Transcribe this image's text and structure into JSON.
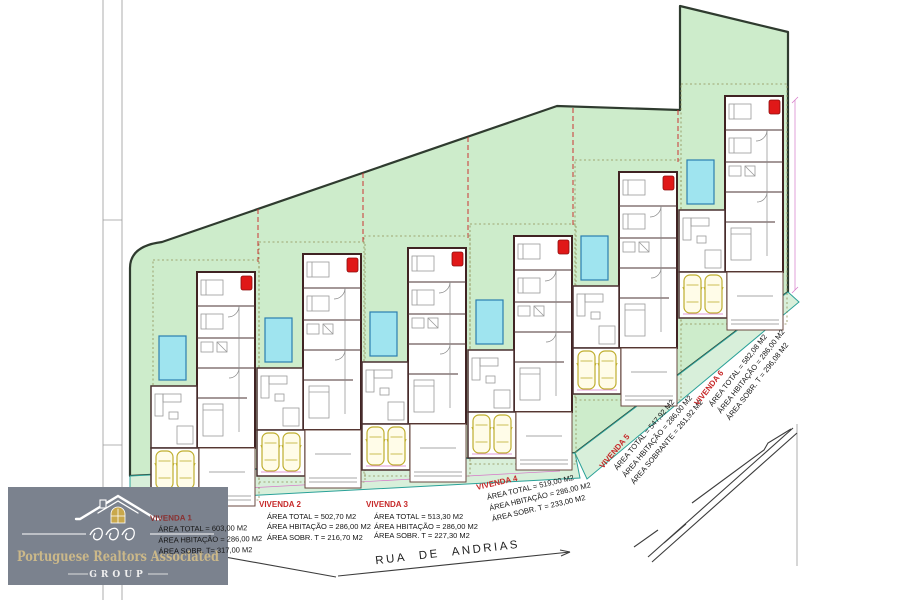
{
  "plan": {
    "street": "RUA DE ANDRIAS",
    "dim_label": "26.88"
  },
  "logo": {
    "name": "Portuguese Realtors Associated",
    "group": "GROUP"
  },
  "villas": [
    {
      "name": "VIVENDA 1",
      "lines": [
        "ÁREA TOTAL = 603,00 M2",
        "ÁREA HBITAÇÃO = 286,00 M2",
        "ÁREA SOBR. T= 317,00 M2"
      ]
    },
    {
      "name": "VIVENDA 2",
      "lines": [
        "ÁREA TOTAL = 502,70 M2",
        "ÁREA HBITAÇÃO = 286,00 M2",
        "ÁREA SOBR. T = 216,70 M2"
      ]
    },
    {
      "name": "VIVENDA 3",
      "lines": [
        "ÁREA TOTAL = 513,30 M2",
        "ÁREA HBITAÇÃO = 286,00 M2",
        "ÁREA SOBR. T = 227,30 M2"
      ]
    },
    {
      "name": "VIVENDA 4",
      "lines": [
        "ÁREA TOTAL = 519,00 M2",
        "ÁREA HBITAÇÃO = 286,00 M2",
        "ÁREA SOBR. T = 233,00 M2"
      ]
    },
    {
      "name": "VIVENDA 5",
      "lines": [
        "ÁREA TOTAL = 547,92 M2",
        "ÁREA HBITAÇÃO = 286,00 M2",
        "ÁREA SOBRANTE = 261,92 M2"
      ]
    },
    {
      "name": "VIVENDA 6",
      "lines": [
        "ÁREA TOTAL = 582,08 M2",
        "ÁREA HBITAÇÃO = 286,00 M2",
        "ÁREA SOBR. T = 296,08 M2"
      ]
    }
  ],
  "colors": {
    "site_green": "#cdeccb",
    "site_outline": "#2f3b2f",
    "strip_green": "#d8efda",
    "strip_teal": "#2aa198",
    "pool_cyan": "#9fe4ef",
    "car_yellow": "#bfae2f",
    "marker_red": "#e01818",
    "lotline_red": "#cc3333",
    "label_red": "#c62828",
    "label_maroon": "#8a3030",
    "dimension_pink": "#d678c8",
    "logo_bg": "#7b828e",
    "logo_gold": "#cbb889"
  }
}
